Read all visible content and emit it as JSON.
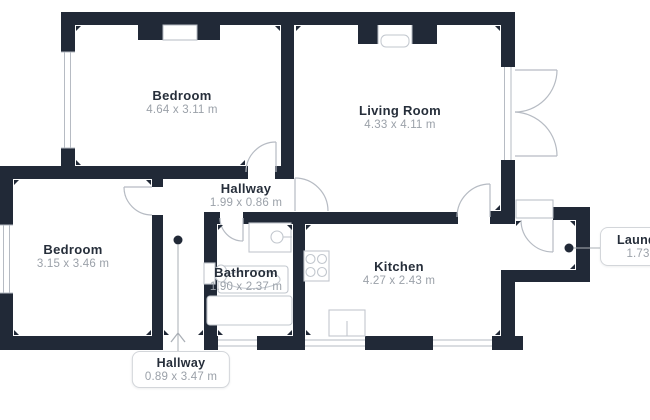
{
  "plan": {
    "title": "apartment-floor-plan",
    "colors": {
      "wall": "#212937",
      "floor": "#ffffff",
      "door_window_line": "#b6bbc3",
      "fixture_line": "#c2c7ce",
      "room_name_text": "#262e3a",
      "dimension_text": "#9ba1a9",
      "leader_line": "#aaafb6",
      "label_box_border": "#d3d6da"
    },
    "rooms": [
      {
        "id": "bedroom-top",
        "name": "Bedroom",
        "dimensions": "4.64 x 3.11 m",
        "label_type": "plain"
      },
      {
        "id": "living-room",
        "name": "Living Room",
        "dimensions": "4.33 x 4.11 m",
        "label_type": "plain"
      },
      {
        "id": "hallway",
        "name": "Hallway",
        "dimensions": "1.99 x 0.86 m",
        "label_type": "plain"
      },
      {
        "id": "bedroom-left",
        "name": "Bedroom",
        "dimensions": "3.15 x 3.46 m",
        "label_type": "plain"
      },
      {
        "id": "bathroom",
        "name": "Bathroom",
        "dimensions": "1.90 x 2.37 m",
        "label_type": "plain"
      },
      {
        "id": "kitchen",
        "name": "Kitchen",
        "dimensions": "4.27 x 2.43 m",
        "label_type": "plain"
      },
      {
        "id": "hallway-entry",
        "name": "Hallway",
        "dimensions": "0.89 x 3.47 m",
        "label_type": "boxed"
      },
      {
        "id": "laundry",
        "name": "Laundry",
        "dimensions": "1.73 x",
        "label_type": "boxed-clipped"
      }
    ],
    "fixtures": [
      "bathroom-sink",
      "bathtub",
      "shower-tray",
      "toilet",
      "stove",
      "kitchen-sink",
      "radiator"
    ],
    "symbols": [
      "door-swing",
      "window",
      "entrance-arrow",
      "leader-dot"
    ]
  }
}
